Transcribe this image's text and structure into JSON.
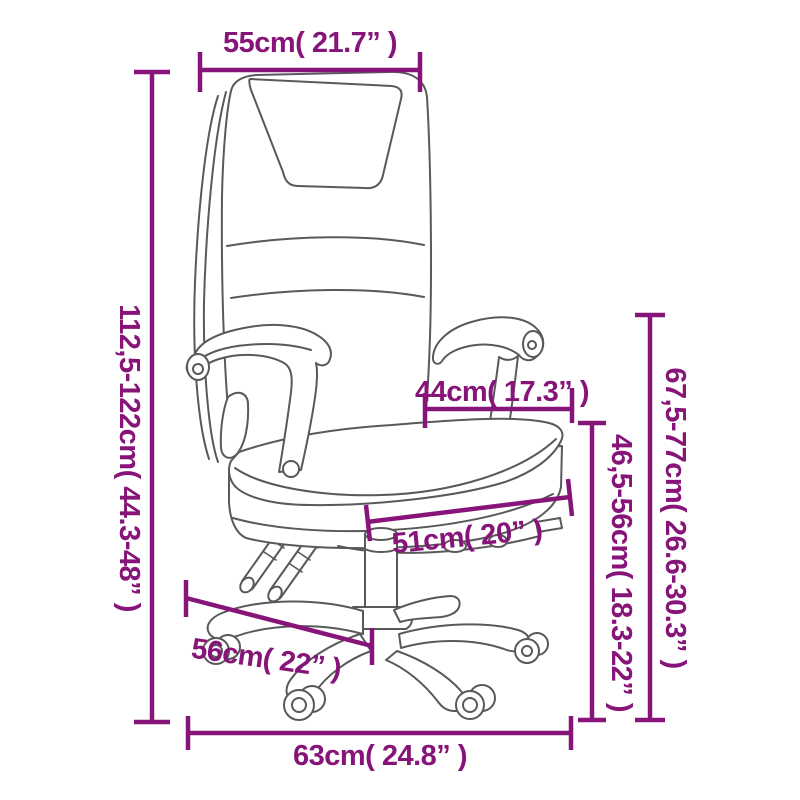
{
  "colors": {
    "dimension_accent": "#871479",
    "drawing_line": "#59595c",
    "background": "#ffffff"
  },
  "dimensions": {
    "top_width": "55cm( 21.7” )",
    "total_height": "112,5-122cm( 44.3-48” )",
    "armrest_span": "44cm( 17.3” )",
    "armrest_floor_height": "67,5-77cm( 26.6-30.3” )",
    "seat_floor_height": "46,5-56cm( 18.3-22” )",
    "seat_depth": "51cm( 20” )",
    "base_diagonal": "56cm( 22” )",
    "base_width": "63cm( 24.8” )"
  }
}
